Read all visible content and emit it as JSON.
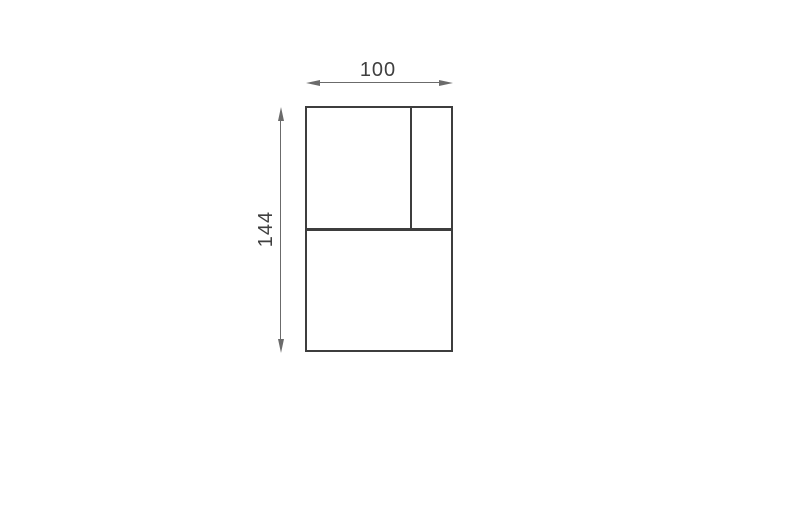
{
  "drawing": {
    "type": "dimensioned-rectangle",
    "width_dimension": {
      "label": "100"
    },
    "height_dimension": {
      "label": "144"
    },
    "colors": {
      "outline": "#3d3d3d",
      "dimension": "#6b6b6b",
      "label": "#3f3f3f",
      "background": "#ffffff"
    }
  }
}
